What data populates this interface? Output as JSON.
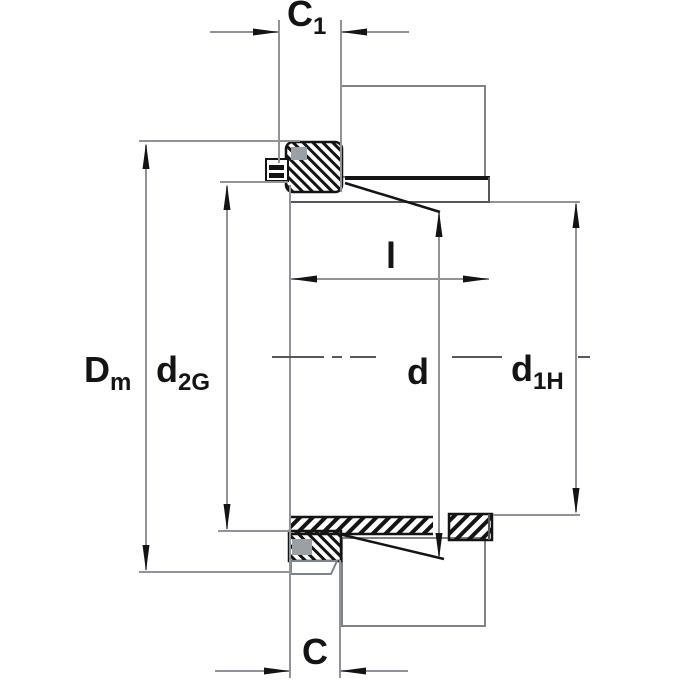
{
  "title": "Adapter sleeve dimensional drawing",
  "labels": {
    "c1": {
      "main": "C",
      "sub": "1"
    },
    "dm": {
      "main": "D",
      "sub": "m"
    },
    "d2g": {
      "main": "d",
      "sub": "2G"
    },
    "l": {
      "main": "l"
    },
    "d": {
      "main": "d"
    },
    "d1h": {
      "main": "d",
      "sub": "1H"
    },
    "c": {
      "main": "C"
    }
  },
  "colors": {
    "ink": "#141414",
    "gray": "#90949a",
    "outline": "#7e8389",
    "mid": "#54585c",
    "slot": "#9aa0a6",
    "background": "#ffffff"
  }
}
